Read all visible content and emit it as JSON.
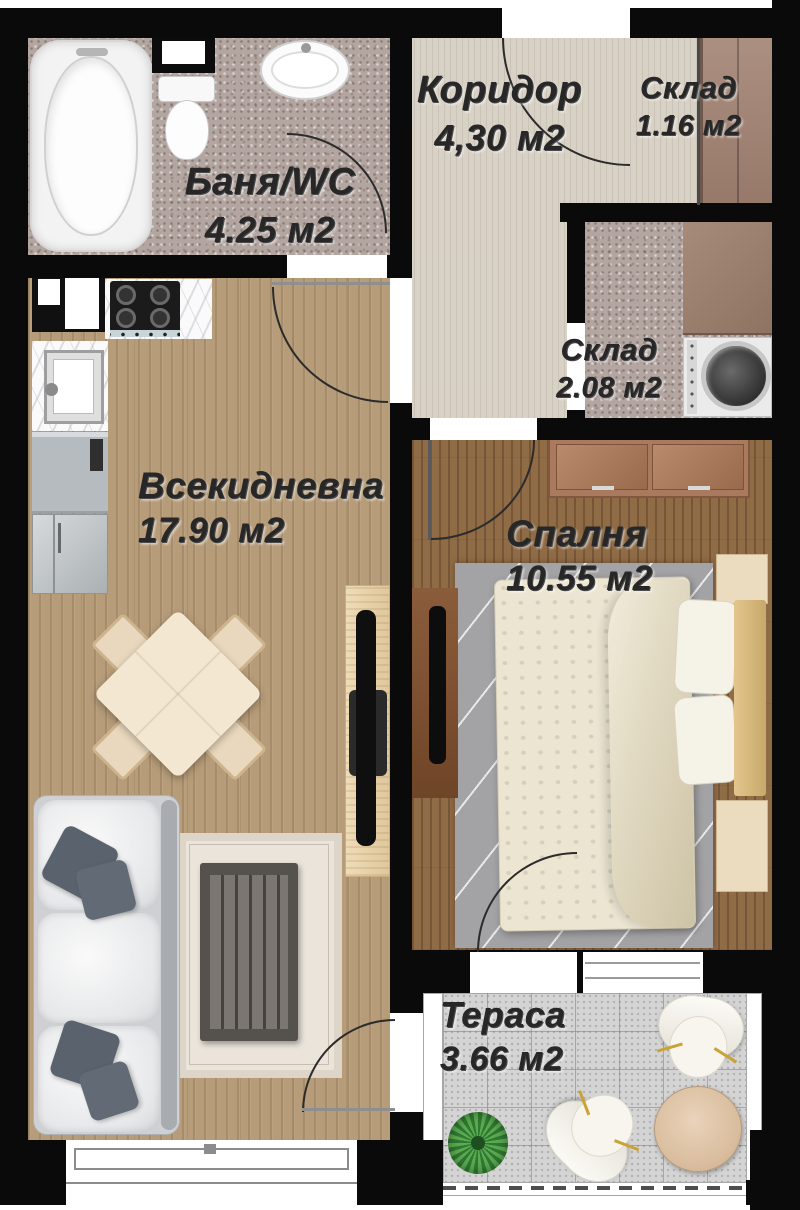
{
  "plan": {
    "type": "apartment-floor-plan",
    "language": "Bulgarian",
    "rooms": [
      {
        "id": "bathroom",
        "name": "Баня/WC",
        "area": "4.25 м2"
      },
      {
        "id": "corridor",
        "name": "Коридор",
        "area": "4,30 м2"
      },
      {
        "id": "storage-small",
        "name": "Склад",
        "area": "1.16 м2"
      },
      {
        "id": "storage-large",
        "name": "Склад",
        "area": "2.08 м2"
      },
      {
        "id": "living-room",
        "name": "Всекидневна",
        "area": "17.90 м2"
      },
      {
        "id": "bedroom",
        "name": "Спалня",
        "area": "10.55 м2"
      },
      {
        "id": "terrace",
        "name": "Тераса",
        "area": "3.66 м2"
      }
    ],
    "colors": {
      "wall": "#0a0a0a",
      "label_text": "#272727",
      "living_floor": "#b69c79",
      "bedroom_floor": "#8f6b46",
      "corridor_floor": "#d8d1c5",
      "bathroom_floor": "#b3a6a1",
      "storage_floor": "#b7a89f",
      "terrace_floor": "#d4d4d4"
    },
    "furniture": [
      "bathtub",
      "toilet",
      "bathroom-sink",
      "wall-niche",
      "kitchen-cabinet",
      "stove",
      "kitchen-sink",
      "dishwasher",
      "fridge",
      "dining-table",
      "dining-chairs",
      "tv-cabinet",
      "tv",
      "sofa",
      "pillows",
      "living-rug",
      "coffee-table",
      "wardrobe",
      "storage-counter",
      "washing-machine",
      "dresser",
      "double-bed",
      "nightstands",
      "bedroom-rug",
      "terrace-chairs",
      "terrace-table",
      "plant"
    ]
  }
}
